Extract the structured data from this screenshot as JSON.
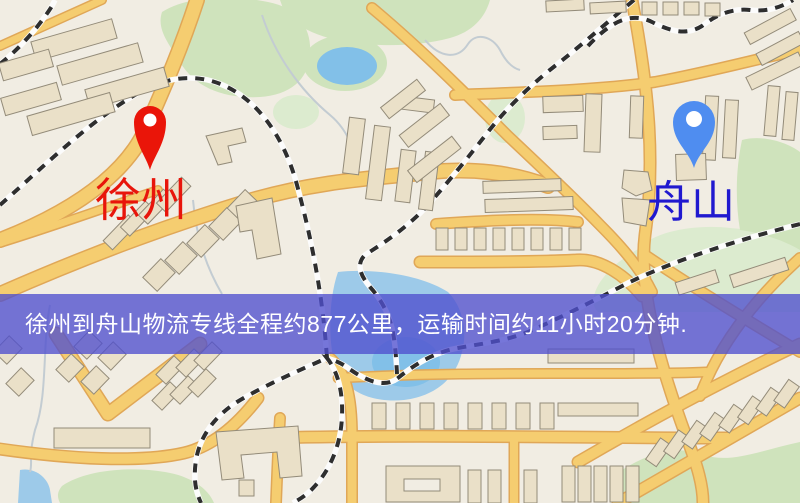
{
  "map": {
    "markers": {
      "origin": {
        "label": "徐州",
        "pin_color": "#ea1509",
        "label_color": "#e8150b"
      },
      "destination": {
        "label": "舟山",
        "pin_color": "#4f8df0",
        "label_color": "#2019cf"
      }
    },
    "banner": {
      "text": "徐州到舟山物流专线全程约877公里，运输时间约11小时20分钟.",
      "background": "#504fce",
      "text_color": "#ffffff"
    },
    "palette": {
      "map_background": "#f1ede3",
      "road_fill": "#f5cd70",
      "road_casing": "#e0a757",
      "building_fill": "#eae0c8",
      "building_outline": "#938b79",
      "green_area": "#cfe3bc",
      "water": "#9dcae9",
      "railway_dark": "#2e2e2e",
      "railway_light": "#fcfcfc",
      "stream": "#c3ccd2"
    }
  }
}
